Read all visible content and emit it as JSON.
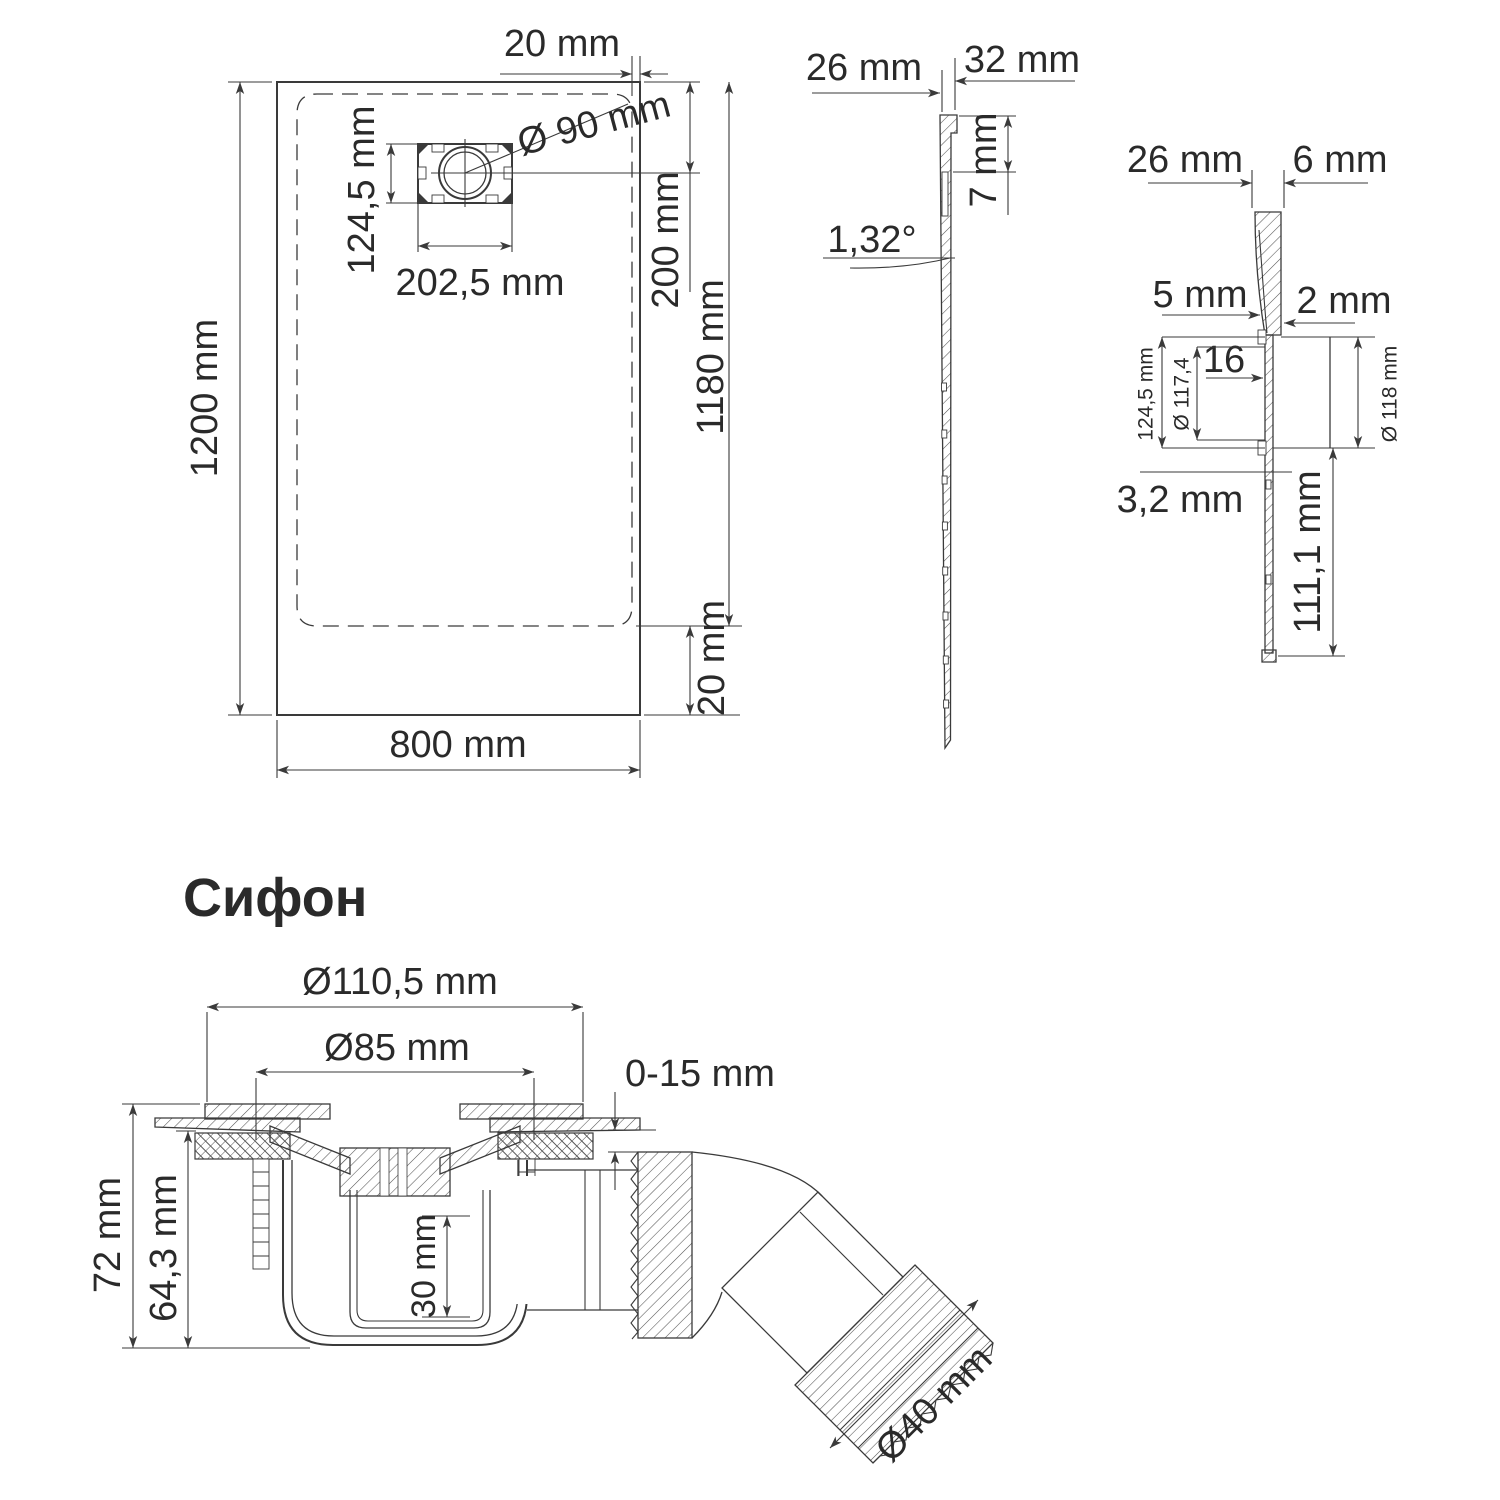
{
  "page": {
    "background": "#ffffff",
    "line_color": "#3a3a3a",
    "text_color": "#2a2a2a"
  },
  "title": {
    "text": "Сифон",
    "color": "#2b3a66"
  },
  "plan_view": {
    "labels": {
      "offset_top": "20 mm",
      "drain_diameter": "Ø 90 mm",
      "drain_box_height": "124,5 mm",
      "drain_box_width": "202,5 mm",
      "drain_center_offset": "200 mm",
      "inner_length": "1180 mm",
      "length": "1200 mm",
      "offset_bottom": "20 mm",
      "width": "800 mm"
    }
  },
  "section_view": {
    "labels": {
      "edge_top_width": "26 mm",
      "edge_total_width": "32 mm",
      "edge_height": "7 mm",
      "slope_angle": "1,32°"
    }
  },
  "detail_view": {
    "labels": {
      "edge_top_width": "26 mm",
      "edge_lip_width": "6 mm",
      "lip_height": "5 mm",
      "gap": "2 mm",
      "insert_depth": "16",
      "flange_height": "124,5 mm",
      "flange_diameter": "Ø 117,4",
      "hole_diameter": "Ø 118 mm",
      "wall_thickness": "3,2 mm",
      "skirt_height": "111,1 mm"
    }
  },
  "siphon_view": {
    "labels": {
      "flange_diameter": "Ø110,5 mm",
      "grate_diameter": "Ø85 mm",
      "adjust_range": "0-15 mm",
      "total_height": "72 mm",
      "body_height": "64,3 mm",
      "trap_depth": "30 mm",
      "outlet_diameter": "Ø40 mm"
    }
  }
}
